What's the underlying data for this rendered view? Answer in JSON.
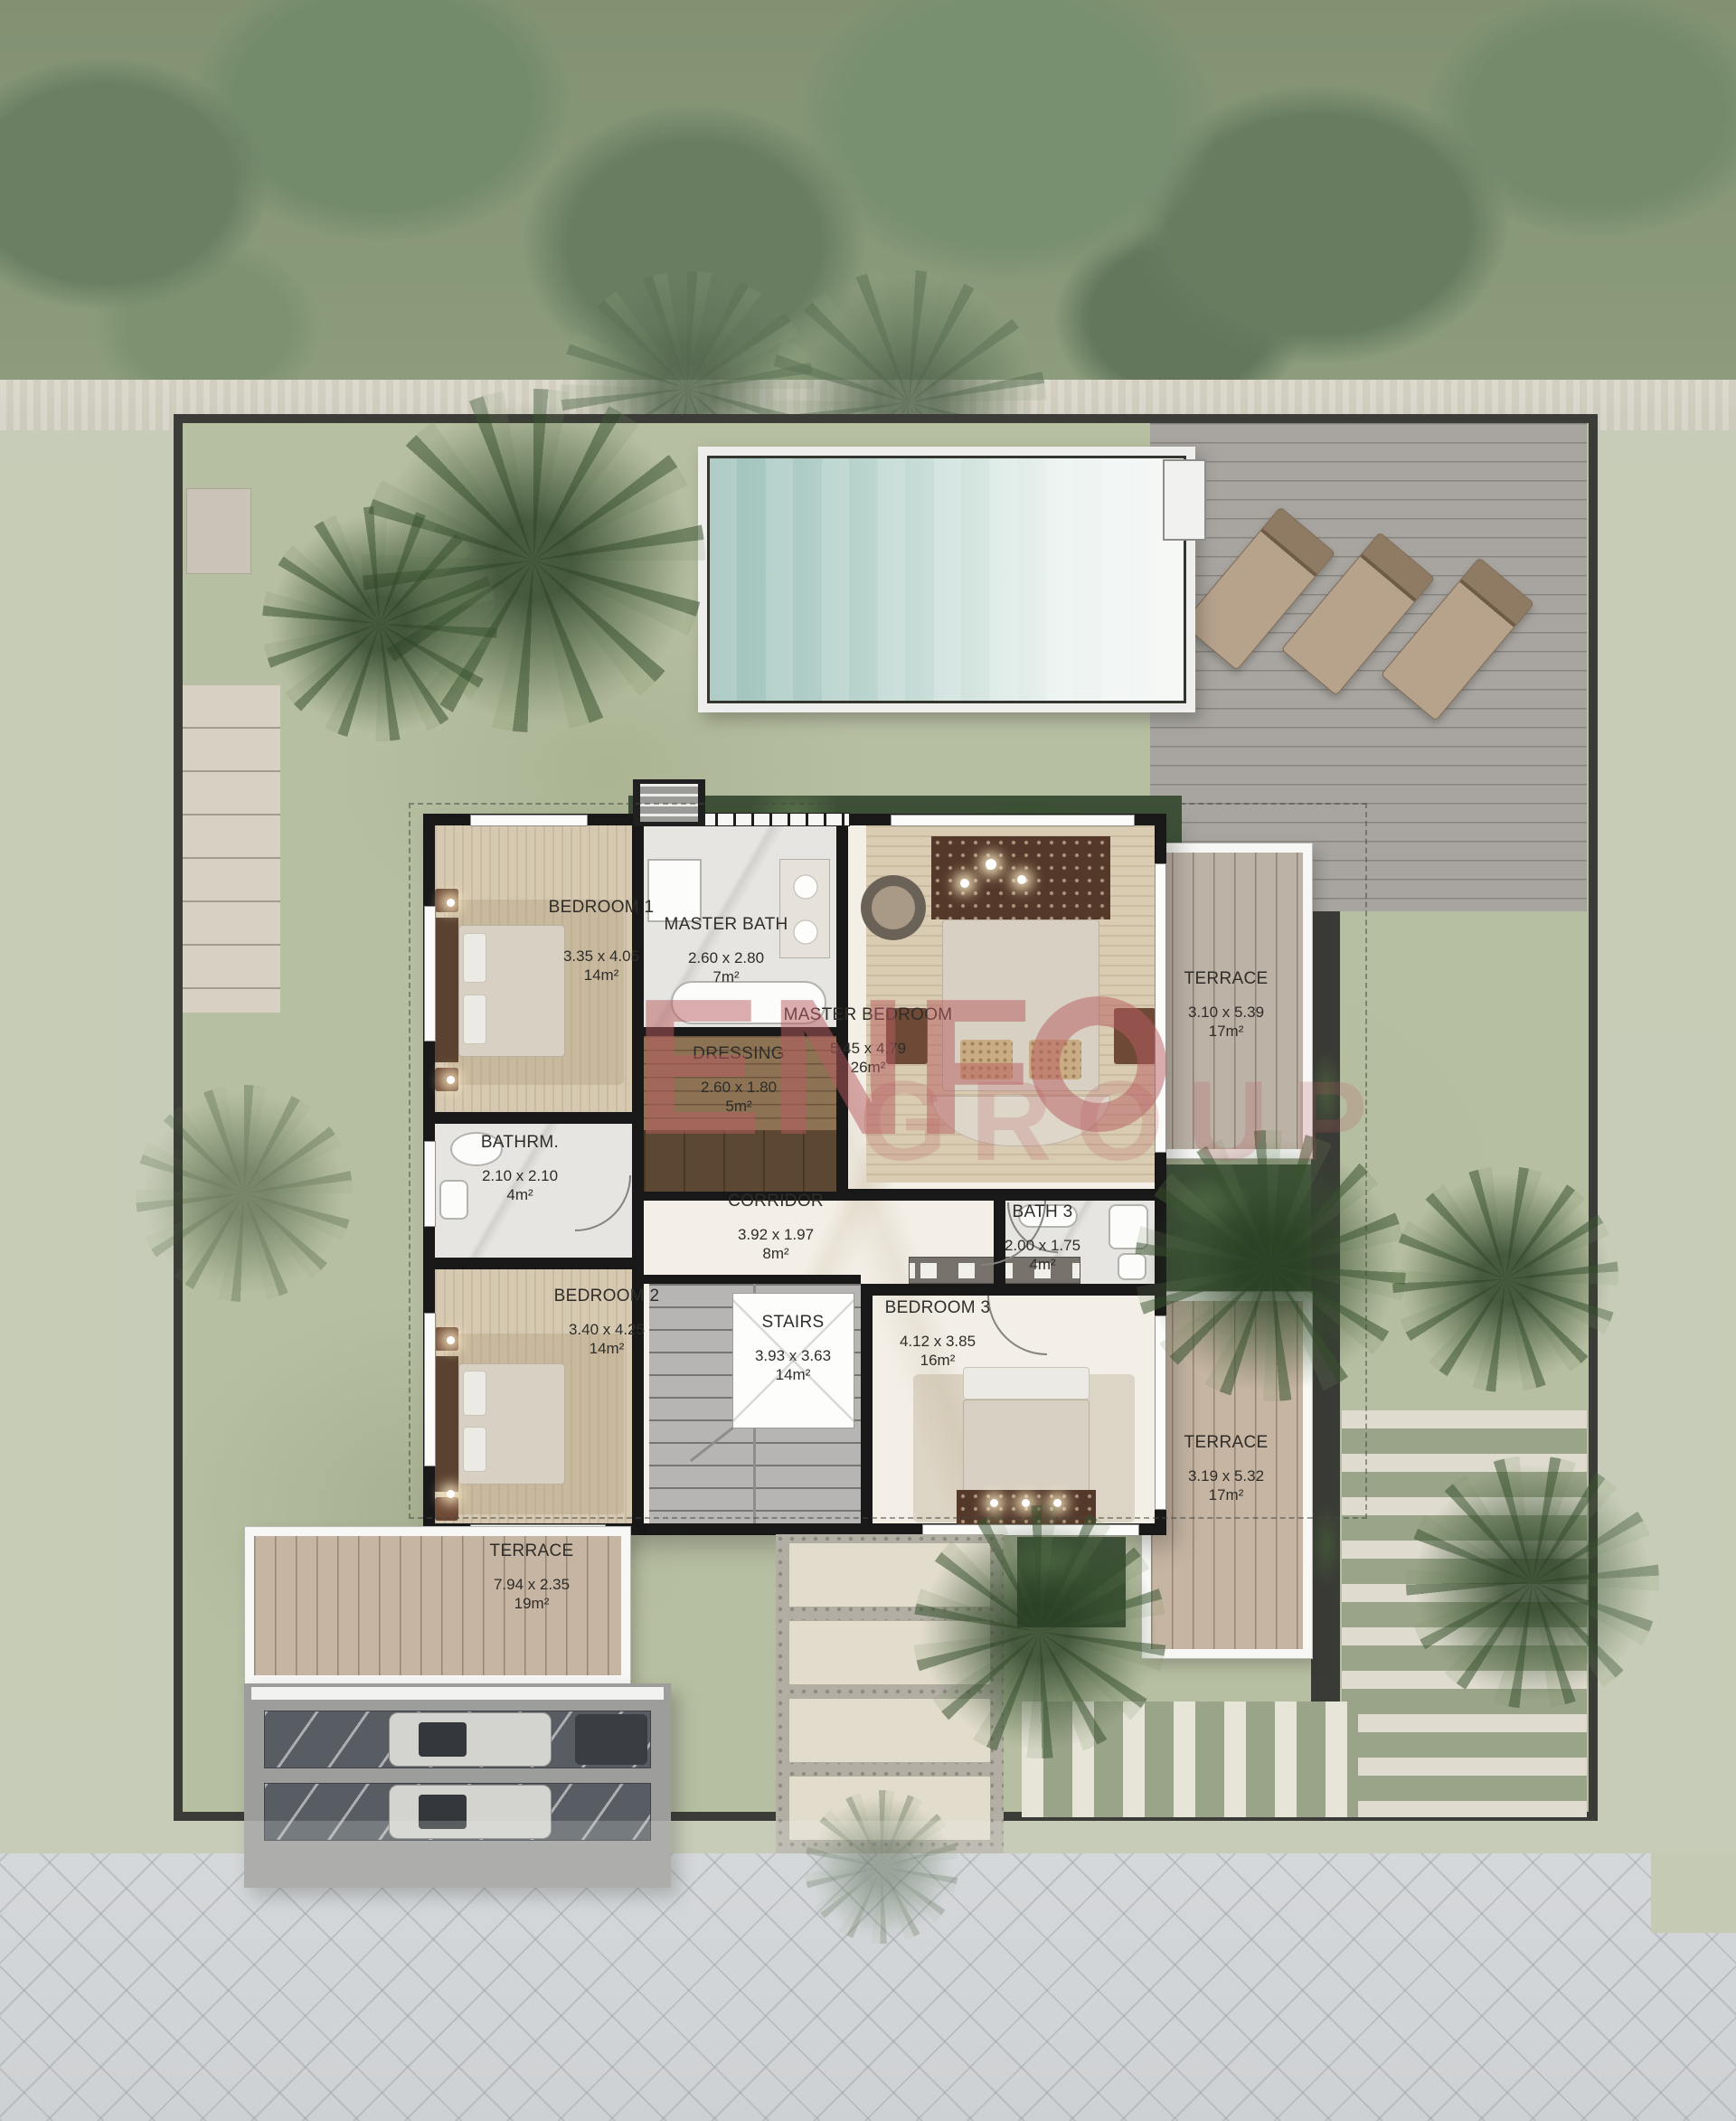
{
  "plan": {
    "type": "villa-floor-plan",
    "rooms": [
      {
        "key": "bedroom-1",
        "name": "BEDROOM 1",
        "dims": "3.35 x 4.05",
        "area": "14m²"
      },
      {
        "key": "master-bath",
        "name": "MASTER BATH",
        "dims": "2.60 x 2.80",
        "area": "7m²"
      },
      {
        "key": "dressing",
        "name": "DRESSING",
        "dims": "2.60 x 1.80",
        "area": "5m²"
      },
      {
        "key": "master-bedroom",
        "name": "MASTER BEDROOM",
        "dims": "5.45 x 4.79",
        "area": "26m²"
      },
      {
        "key": "terrace-ne",
        "name": "TERRACE",
        "dims": "3.10 x 5.39",
        "area": "17m²"
      },
      {
        "key": "bathrm",
        "name": "BATHRM.",
        "dims": "2.10 x 2.10",
        "area": "4m²"
      },
      {
        "key": "corridor",
        "name": "CORRIDOR",
        "dims": "3.92 x 1.97",
        "area": "8m²"
      },
      {
        "key": "bath-3",
        "name": "BATH 3",
        "dims": "2.00 x 1.75",
        "area": "4m²"
      },
      {
        "key": "bedroom-2",
        "name": "BEDROOM 2",
        "dims": "3.40 x 4.25",
        "area": "14m²"
      },
      {
        "key": "stairs",
        "name": "STAIRS",
        "dims": "3.93 x 3.63",
        "area": "14m²"
      },
      {
        "key": "bedroom-3",
        "name": "BEDROOM 3",
        "dims": "4.12 x 3.85",
        "area": "16m²"
      },
      {
        "key": "terrace-se",
        "name": "TERRACE",
        "dims": "3.19 x 5.32",
        "area": "17m²"
      },
      {
        "key": "terrace-sw",
        "name": "TERRACE",
        "dims": "7.94 x 2.35",
        "area": "19m²"
      }
    ]
  },
  "watermark": {
    "text": "ENF",
    "secondary": "GROUP",
    "color": "#b85c60"
  },
  "palette": {
    "watermark_red": "#b85c60",
    "pool_water_teal": "#9fc2bb",
    "lawn_green": "#b7bfa2",
    "forest_green": "#56714a",
    "deck_gray": "#a8a5a0",
    "terrace_wood": "#c6b5a2",
    "interior_wall_black": "#181818",
    "lot_wall_gray": "#3b3c37",
    "carpet_beige": "#d6c9b1",
    "street_pavers": "#ced1d5",
    "planter_green": "#3e5138"
  }
}
